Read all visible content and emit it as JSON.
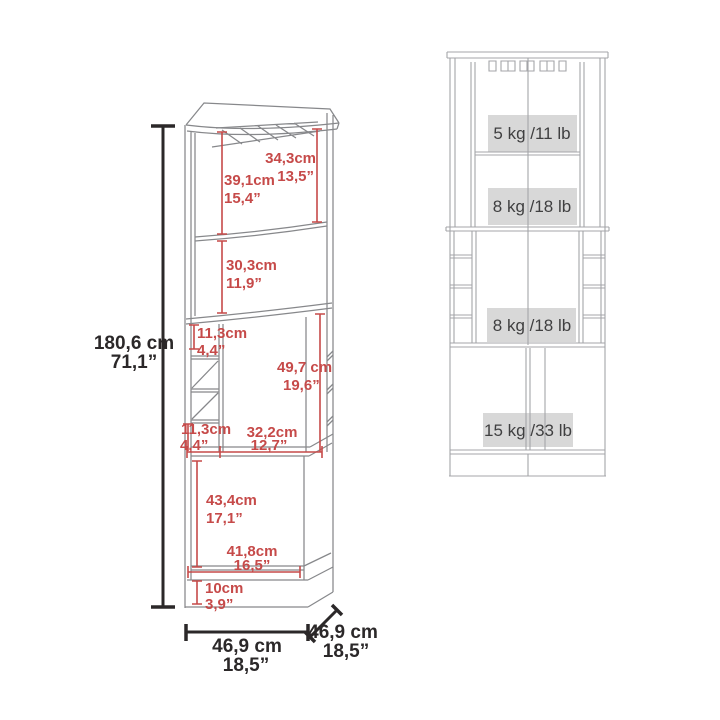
{
  "left_figure": {
    "overall_height": {
      "cm": "180,6 cm",
      "inch": "71,1”"
    },
    "width": {
      "cm": "46,9 cm",
      "inch": "18,5”"
    },
    "depth": {
      "cm": "46,9 cm",
      "inch": "18,5”"
    },
    "dimensions": [
      {
        "name": "glass-rack-to-shelf-height",
        "cm": "34,3cm",
        "inch": "13,5”"
      },
      {
        "name": "top-compartment-height",
        "cm": "39,1cm",
        "inch": "15,4”"
      },
      {
        "name": "second-compartment-height",
        "cm": "30,3cm",
        "inch": "11,9”"
      },
      {
        "name": "upper-cubby-height",
        "cm": "11,3cm",
        "inch": "4,4”"
      },
      {
        "name": "middle-opening-height",
        "cm": "49,7 cm",
        "inch": "19,6”"
      },
      {
        "name": "lower-cubby-height",
        "cm": "11,3cm",
        "inch": "4,4”"
      },
      {
        "name": "middle-opening-width",
        "cm": "32,2cm",
        "inch": "12,7”"
      },
      {
        "name": "cabinet-interior-height",
        "cm": "43,4cm",
        "inch": "17,1”"
      },
      {
        "name": "cabinet-interior-width",
        "cm": "41,8cm",
        "inch": "16,5”"
      },
      {
        "name": "base-height",
        "cm": "10cm",
        "inch": "3,9”"
      }
    ]
  },
  "right_figure": {
    "capacities": [
      {
        "shelf": "top-shelf",
        "label": "5 kg /11 lb"
      },
      {
        "shelf": "second-shelf",
        "label": "8 kg /18 lb"
      },
      {
        "shelf": "middle-shelf",
        "label": "8 kg /18 lb"
      },
      {
        "shelf": "bottom-cabinet",
        "label": "15 kg /33 lb"
      }
    ]
  },
  "colors": {
    "dimension_red": "#c64a49",
    "dimension_black": "#2b2829",
    "line_dark": "#87888b",
    "line_light": "#a4a5a8",
    "capacity_box": "#d8d8d8",
    "capacity_text": "#3f3f40",
    "background": "#ffffff"
  }
}
